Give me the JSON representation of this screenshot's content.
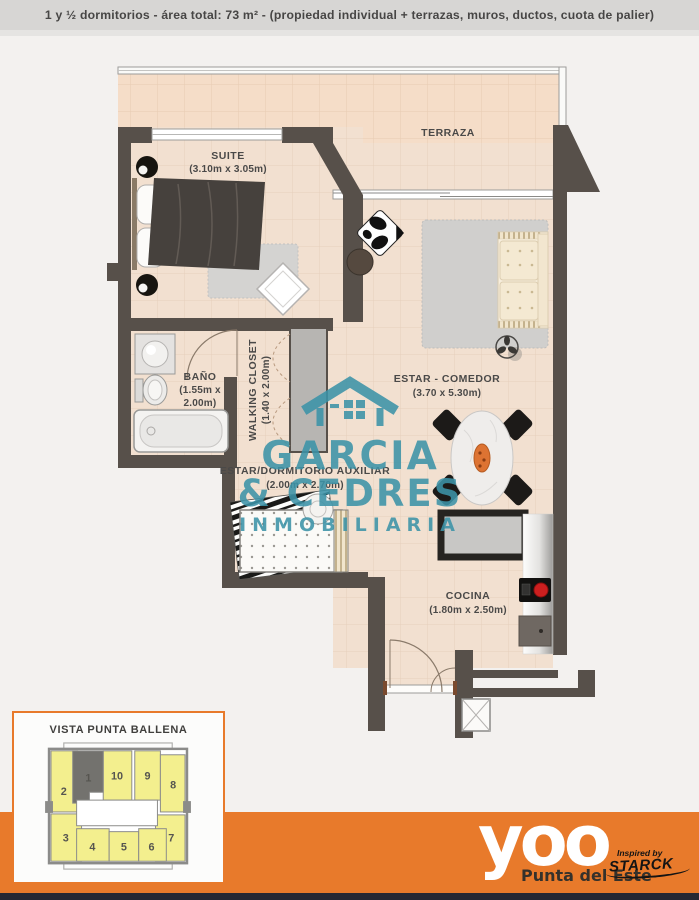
{
  "header": {
    "text": "1 y ½ dormitorios - área total: 73 m² - (propiedad individual + terrazas, muros, ductos, cuota de palier)"
  },
  "plan": {
    "suite": {
      "name": "SUITE",
      "dims": "(3.10m x 3.05m)"
    },
    "terraza": {
      "name": "TERRAZA"
    },
    "bano": {
      "name": "BAÑO",
      "dims1": "(1.55m x",
      "dims2": "2.00m)"
    },
    "walking_closet": {
      "name": "WALKING CLOSET",
      "dims": "(1.40 x 2.00m)"
    },
    "estar_comedor": {
      "name": "ESTAR - COMEDOR",
      "dims": "(3.70 x 5.30m)"
    },
    "estar_dormitorio_auxiliar": {
      "name": "ESTAR/DORMITORIO AUXILIAR",
      "dims": "(2.00m x 2.70m)"
    },
    "cocina": {
      "name": "COCINA",
      "dims": "(1.80m x 2.50m)"
    }
  },
  "watermark": {
    "line1": "GARCIA",
    "line2": "& CEDRES",
    "line3": "INMOBILIARIA",
    "color": "#3c93a8"
  },
  "inset": {
    "title": "VISTA PUNTA BALLENA",
    "highlighted_unit": "1",
    "units": [
      {
        "label": "1",
        "highlighted": true
      },
      {
        "label": "2",
        "highlighted": false
      },
      {
        "label": "3",
        "highlighted": false
      },
      {
        "label": "4",
        "highlighted": false
      },
      {
        "label": "5",
        "highlighted": false
      },
      {
        "label": "6",
        "highlighted": false
      },
      {
        "label": "7",
        "highlighted": false
      },
      {
        "label": "8",
        "highlighted": false
      },
      {
        "label": "9",
        "highlighted": false
      },
      {
        "label": "10",
        "highlighted": false
      }
    ]
  },
  "footer": {
    "brand": "yoo",
    "location": "Punta del Este",
    "inspired_by": "Inspired by",
    "designer": "STARCK"
  },
  "colors": {
    "accent_orange": "#e87a2b",
    "watermark_teal": "#3c93a8",
    "wall": "#57504a",
    "floor": "#f2e0d0",
    "unit_yellow": "#f3ef8e",
    "unit_highlight": "#73726e"
  }
}
